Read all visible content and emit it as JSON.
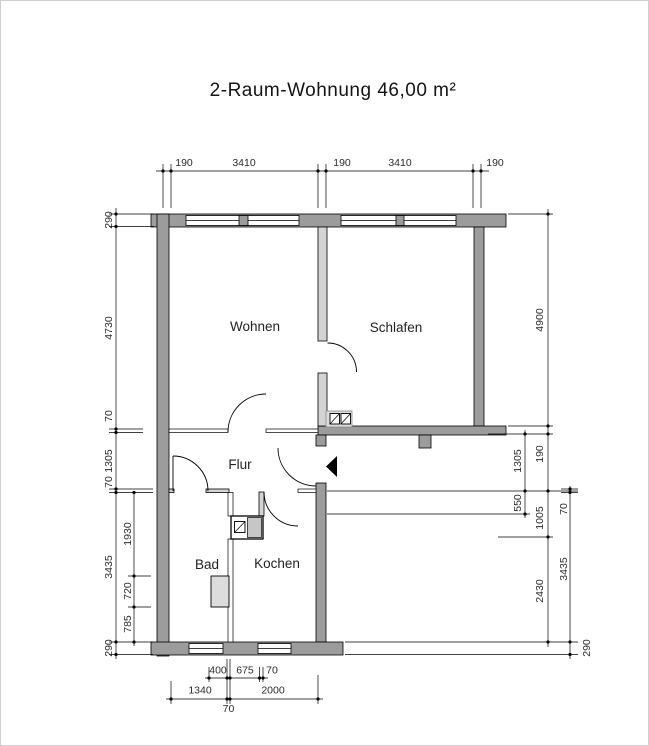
{
  "title": "2-Raum-Wohnung  46,00 m²",
  "rooms": {
    "wohnen": "Wohnen",
    "schlafen": "Schlafen",
    "flur": "Flur",
    "bad": "Bad",
    "kochen": "Kochen"
  },
  "dims": {
    "top": [
      "190",
      "3410",
      "190",
      "3410",
      "190"
    ],
    "left_outer": [
      "290",
      "4730",
      "70",
      "1305",
      "70",
      "3435",
      "290"
    ],
    "left_inner": [
      "1930",
      "720",
      "785"
    ],
    "right_inner": [
      "1305",
      "550"
    ],
    "right_middle": [
      "4900",
      "190",
      "1005",
      "2430"
    ],
    "right_outer": [
      "70",
      "3435",
      "290"
    ],
    "bottom_upper": [
      "400",
      "675",
      "70"
    ],
    "bottom_lower": [
      "1340",
      "2000",
      "70"
    ]
  },
  "colors": {
    "wall_dark": "#9c9c9c",
    "wall_light": "#d4d4d4",
    "fixture_light": "#dcdcdc",
    "shaft_gray": "#c6c6c6",
    "marker_black": "#000000"
  }
}
